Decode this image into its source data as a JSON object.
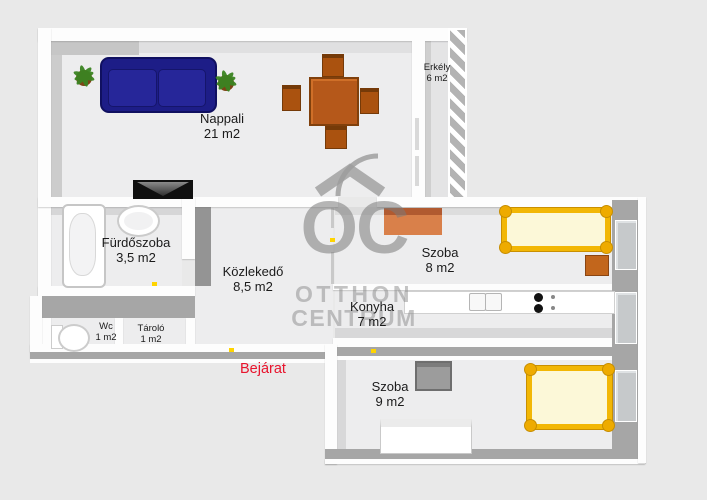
{
  "background": "#e9e9e9",
  "rooms": [
    {
      "name": "nappali",
      "label": "Nappali",
      "area": "21 m2"
    },
    {
      "name": "erkely",
      "label": "Erkély",
      "area": "6 m2"
    },
    {
      "name": "furdoszoba",
      "label": "Fürdőszoba",
      "area": "3,5 m2"
    },
    {
      "name": "kozlekedo",
      "label": "Közlekedő",
      "area": "8,5 m2"
    },
    {
      "name": "szoba-8",
      "label": "Szoba",
      "area": "8 m2"
    },
    {
      "name": "konyha",
      "label": "Konyha",
      "area": "7 m2"
    },
    {
      "name": "wc",
      "label": "Wc",
      "area": "1 m2"
    },
    {
      "name": "tarolo",
      "label": "Tároló",
      "area": "1 m2"
    },
    {
      "name": "szoba-9",
      "label": "Szoba",
      "area": "9 m2"
    }
  ],
  "entrance": {
    "label": "Bejárat",
    "color": "#e8142d"
  },
  "watermark": {
    "monogram": "OC",
    "line1": "OTTHON",
    "line2": "CENTRUM"
  },
  "furniture_icons": [
    "sofa",
    "potted-plant",
    "dining-table",
    "chair",
    "tv",
    "bathtub",
    "washbasin",
    "toilet",
    "desk",
    "double-bed",
    "nightstand",
    "kitchen-counter",
    "kitchen-sink",
    "stove",
    "armchair",
    "dresser",
    "window",
    "door-swing-arc",
    "balcony-railing",
    "door-marker"
  ],
  "colors": {
    "sofa": "#1d1d87",
    "wood": "#b5581a",
    "desk": "#d9804a",
    "bed_frame": "#f2b705",
    "bed_mattress": "#fcf8d8",
    "wall": "#fdfdfd",
    "floor": "#ededee",
    "watermark_gray": "#8c8c8c",
    "entrance_red": "#e8142d",
    "door_marker": "#ffd400"
  }
}
